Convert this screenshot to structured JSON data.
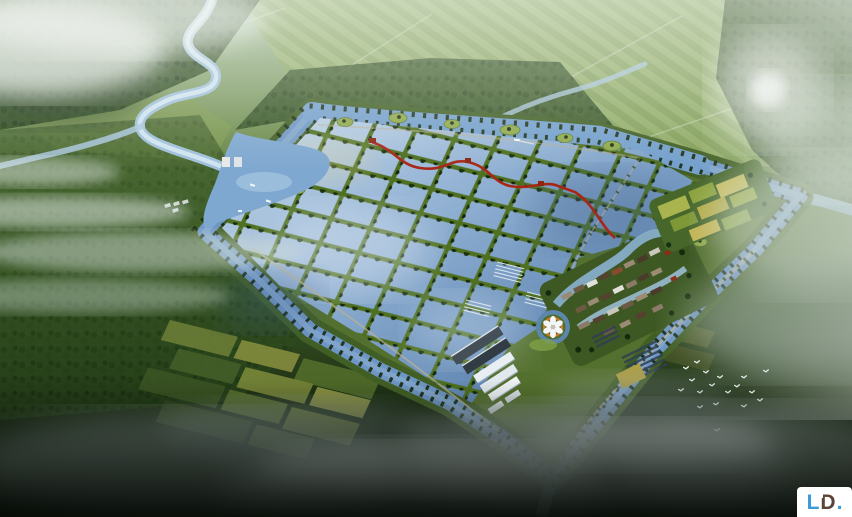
{
  "canvas": {
    "width": 852,
    "height": 517
  },
  "logo": {
    "letter_l": "L",
    "letter_d": "D",
    "period": ".",
    "color_blue": "#3b9ad8",
    "color_brown": "#5d4335",
    "badge_background": "#ffffff"
  },
  "scene": {
    "palette": {
      "pond_water": "#7b9cc6",
      "perimeter_canal": "#6e96c4",
      "dike_green": "#4e7020",
      "farmland_light": "#8fa861",
      "forest_dark": "#24411a",
      "mist": "#dfe8e4",
      "deep_shadow": "#070e07",
      "boardwalk_red": "#a82616",
      "lotus_orange": "#d4782a",
      "rooftop_tan": "#9b8a74",
      "greenhouse_white": "#e9eef2"
    }
  }
}
